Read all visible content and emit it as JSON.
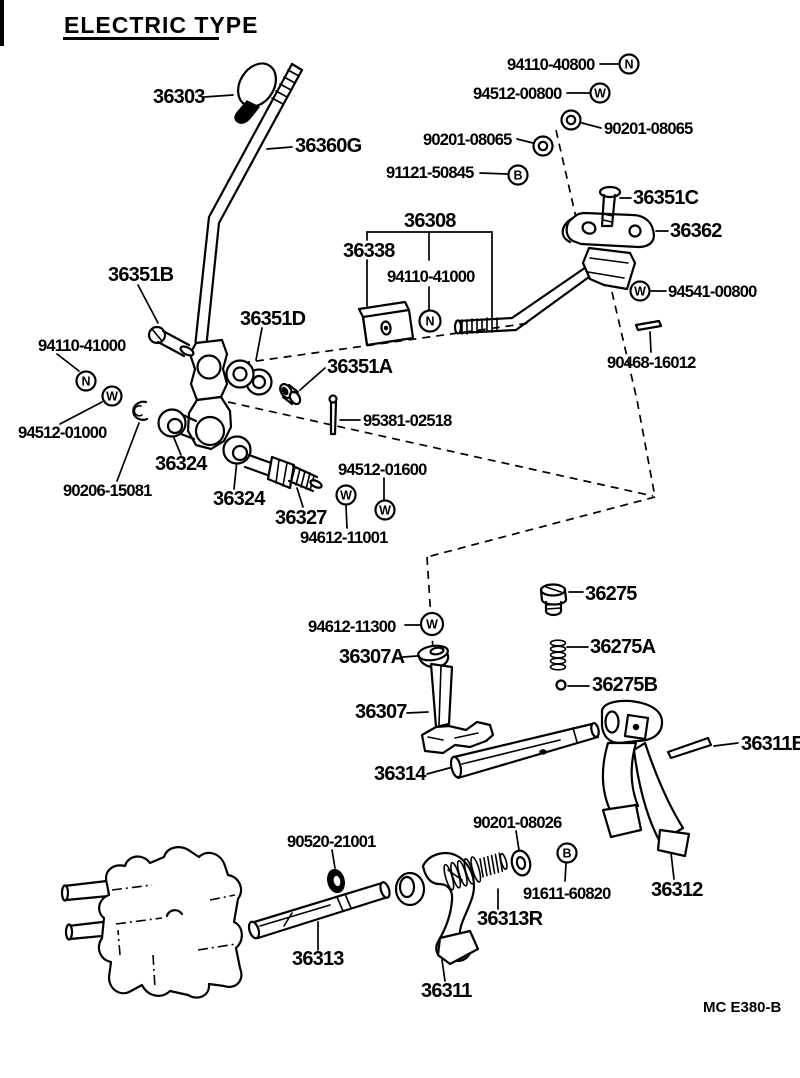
{
  "title": "ELECTRIC TYPE",
  "diagram_code": "MC E380-B",
  "colors": {
    "ink": "#000000",
    "paper": "#ffffff"
  },
  "badge_letters": {
    "nut": "N",
    "washer": "W",
    "bolt": "B"
  },
  "labels": {
    "knob": "36303",
    "shift_lever": "36360G",
    "nut_94110_40800": "94110-40800",
    "washer_94512_00800": "94512-00800",
    "washer_90201_08065_right": "90201-08065",
    "washer_90201_08065_left": "90201-08065",
    "bolt_91121_50845": "91121-50845",
    "pin_36351c": "36351C",
    "bracket_36362": "36362",
    "rod_36308": "36308",
    "switch_36338": "36338",
    "nut_94110_41000_center": "94110-41000",
    "washer_94541_00800": "94541-00800",
    "pin_90468_16012": "90468-16012",
    "bolt_36351b": "36351B",
    "bushing_36351d": "36351D",
    "bushing_36351a": "36351A",
    "nut_94110_41000_left": "94110-41000",
    "washer_94512_01000": "94512-01000",
    "clip_90206_15081": "90206-15081",
    "link_36324_upper": "36324",
    "link_36324_lower": "36324",
    "joint_36327": "36327",
    "pin_95381_02518": "95381-02518",
    "washer_94512_01600": "94512-01600",
    "washer_94612_11001": "94612-11001",
    "plug_36275": "36275",
    "spring_36275a": "36275A",
    "ball_36275b": "36275B",
    "washer_94612_11300": "94612-11300",
    "cap_36307a": "36307A",
    "inner_lever_36307": "36307",
    "head_rod_36314": "36314",
    "pin_36311b": "36311B",
    "fork_36312": "36312",
    "ring_90520_21001": "90520-21001",
    "washer_90201_08026": "90201-08026",
    "bolt_91611_60820": "91611-60820",
    "spring_36313r": "36313R",
    "rod_36313": "36313",
    "fork_36311": "36311"
  }
}
